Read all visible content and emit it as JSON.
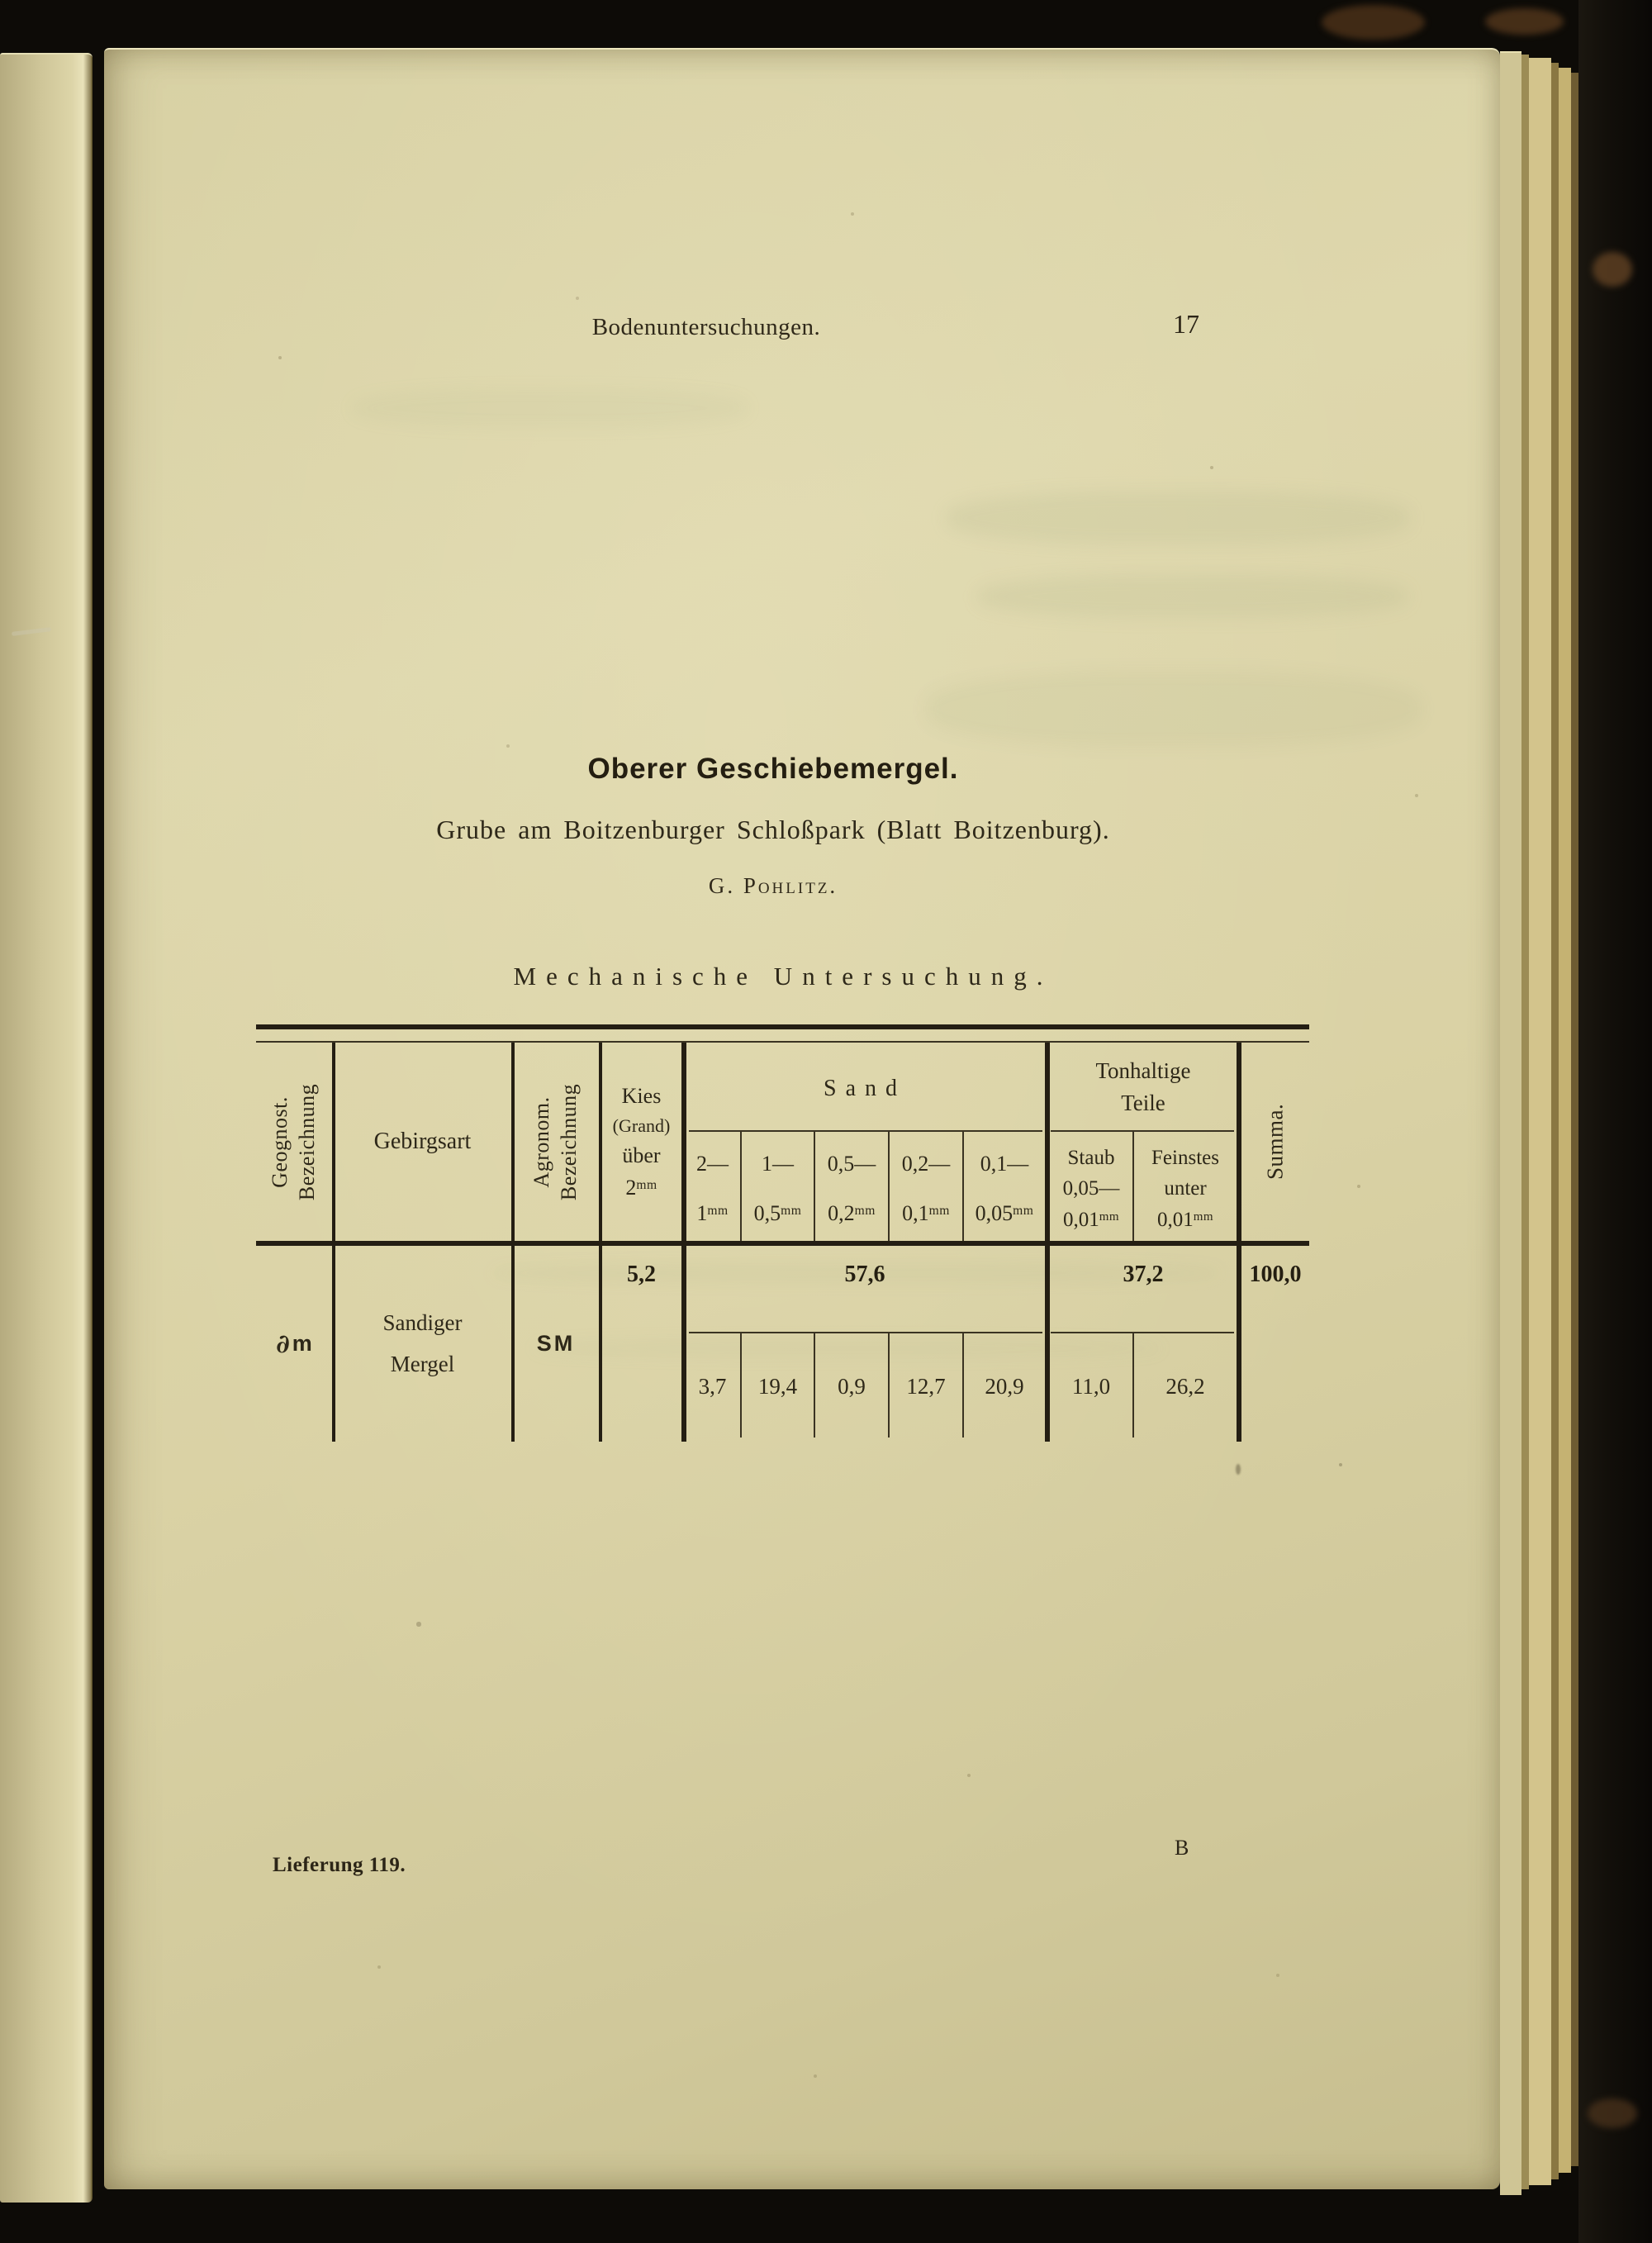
{
  "doc": {
    "running_header": "Bodenuntersuchungen.",
    "page_number": "17",
    "title": "Oberer Geschiebemergel.",
    "subtitle": "Grube am Boitzenburger Schloßpark (Blatt Boitzenburg).",
    "author": "G. Pohlitz.",
    "section_heading": "Mechanische Untersuchung.",
    "footer_left": "Lieferung 119.",
    "signature_mark": "B"
  },
  "table": {
    "headers": {
      "geognost": [
        "Geognost.",
        "Bezeichnung"
      ],
      "gebirgsart": "Gebirgsart",
      "agronom": [
        "Agronom.",
        "Bezeichnung"
      ],
      "kies": [
        "Kies",
        "(Grand)",
        "über"
      ],
      "kies_limit": {
        "num": "2",
        "unit": "mm"
      },
      "sand": "Sand",
      "sand_ranges": [
        {
          "from": "2—",
          "to": "1",
          "unit": "mm"
        },
        {
          "from": "1—",
          "to": "0,5",
          "unit": "mm"
        },
        {
          "from": "0,5—",
          "to": "0,2",
          "unit": "mm"
        },
        {
          "from": "0,2—",
          "to": "0,1",
          "unit": "mm"
        },
        {
          "from": "0,1—",
          "to": "0,05",
          "unit": "mm"
        }
      ],
      "tonhaltige": [
        "Tonhaltige",
        "Teile"
      ],
      "staub": [
        "Staub",
        "0,05—"
      ],
      "staub_limit": {
        "num": "0,01",
        "unit": "mm"
      },
      "feinstes": [
        "Feinstes",
        "unter"
      ],
      "feinstes_limit": {
        "num": "0,01",
        "unit": "mm"
      },
      "summa": "Summa."
    },
    "row": {
      "geognost_symbol": {
        "partial": "∂",
        "letter": "m"
      },
      "gebirgsart": [
        "Sandiger",
        "Mergel"
      ],
      "agronom": "SM",
      "kies": "5,2",
      "sand_total": "57,6",
      "sand_values": [
        "3,7",
        "19,4",
        "0,9",
        "12,7",
        "20,9"
      ],
      "tonhaltige_total": "37,2",
      "tonhaltige_values": [
        "11,0",
        "26,2"
      ],
      "summa": "100,0"
    }
  }
}
